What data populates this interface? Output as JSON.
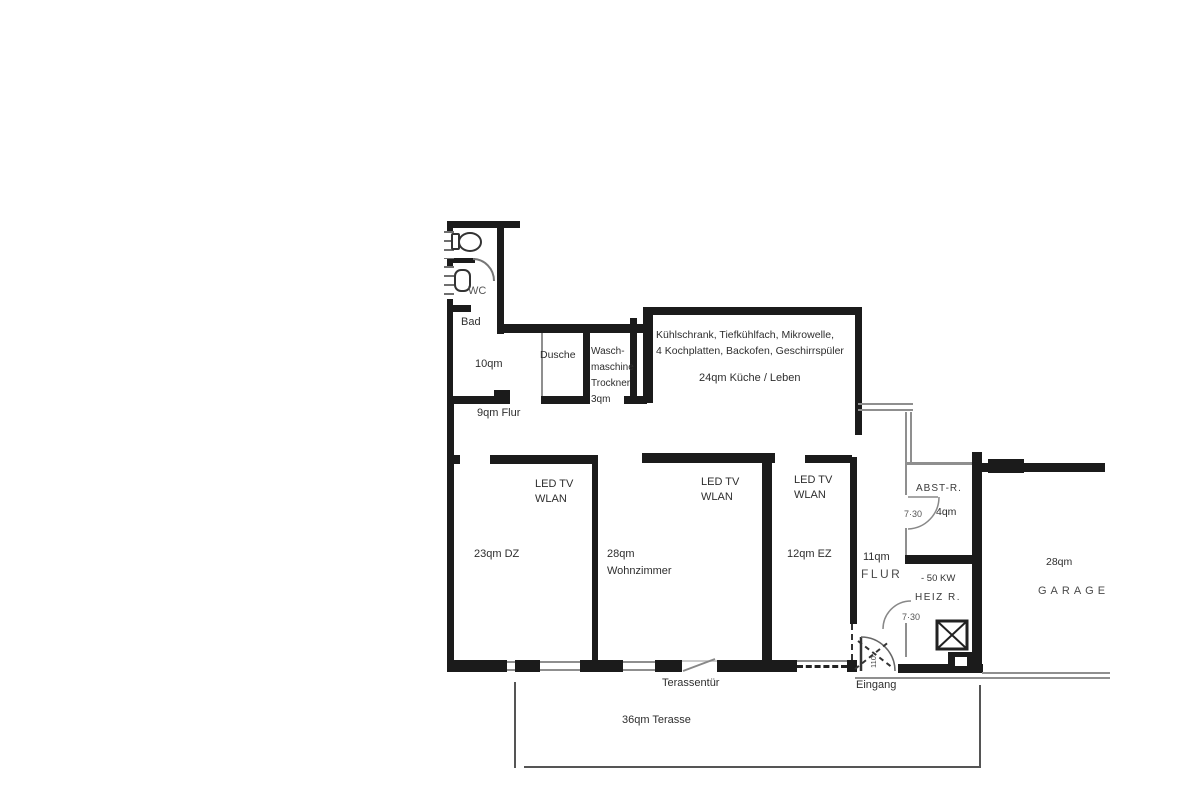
{
  "plan": {
    "bathroom": {
      "wc_label": "WC",
      "name": "Bad",
      "area": "10qm"
    },
    "shower": {
      "name": "Dusche"
    },
    "laundry": {
      "name": "Wasch-\nmaschine\nTrockner\n3qm"
    },
    "kitchen": {
      "equipment": "Kühlschrank, Tiefkühlfach, Mikrowelle,\n4 Kochplatten, Backofen, Geschirrspüler",
      "name": "24qm Küche / Leben"
    },
    "hall_small": {
      "name": "9qm Flur"
    },
    "bedroom_dz": {
      "tv": "LED TV\nWLAN",
      "name": "23qm DZ"
    },
    "living_room": {
      "tv": "LED TV\nWLAN",
      "name": "28qm\nWohnzimmer"
    },
    "bedroom_ez": {
      "tv": "LED TV\nWLAN",
      "name": "12qm EZ"
    },
    "hall_main": {
      "area": "11qm",
      "name": "FLUR"
    },
    "storage": {
      "name": "ABST-R.",
      "door_width": "7·30",
      "area": "4qm"
    },
    "boiler_room": {
      "power": "- 50 KW",
      "name": "HEIZ R.",
      "door_width": "7·30"
    },
    "garage": {
      "area": "28qm",
      "name": "GARAGE"
    },
    "terrace_door": "Terassentür",
    "entrance": "Eingang",
    "entrance_door_width": "110",
    "terrace": "36qm Terasse"
  },
  "colors": {
    "wall": "#1b1b1b",
    "thin_line": "#8f8f8f",
    "text": "#2e2e2e",
    "background": "#ffffff"
  }
}
